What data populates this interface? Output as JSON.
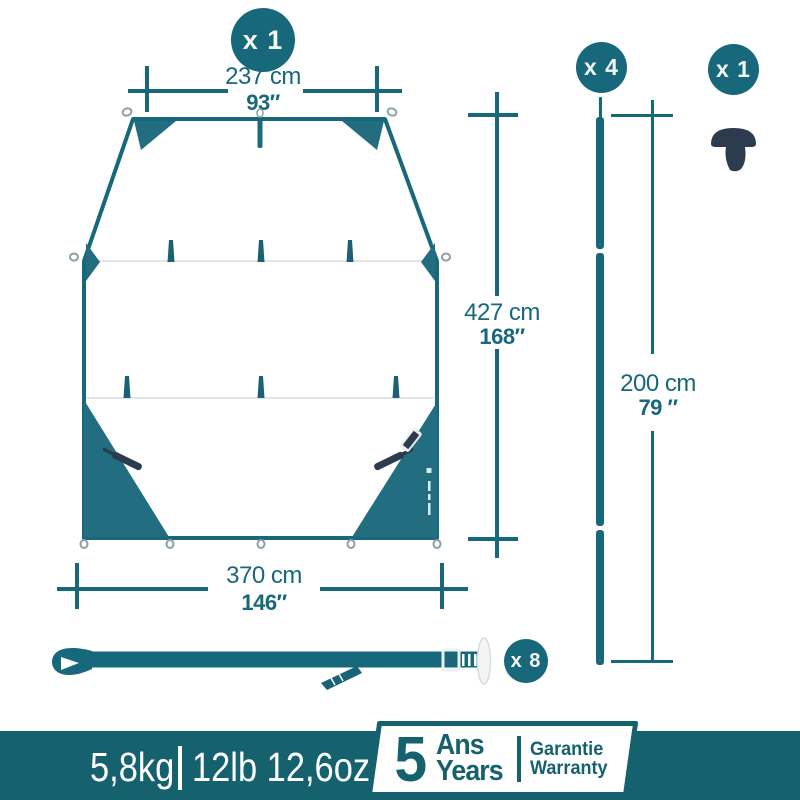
{
  "product": {
    "tarp_qty": "x 1",
    "pole_qty": "x 4",
    "peg_qty": "x 1",
    "strap_qty": "x 8"
  },
  "dimensions": {
    "top_width_cm": "237 cm",
    "top_width_in": "93″",
    "height_cm": "427 cm",
    "height_in": "168″",
    "bottom_width_cm": "370 cm",
    "bottom_width_in": "146″",
    "pole_length_cm": "200 cm",
    "pole_length_in": "79 ″"
  },
  "footer": {
    "weight_metric": "5,8kg",
    "weight_imperial": "12lb 12,6oz",
    "warranty_years": "5",
    "warranty_word_fr": "Ans",
    "warranty_word_en": "Years",
    "warranty_label_fr": "Garantie",
    "warranty_label_en": "Warranty"
  },
  "colors": {
    "teal": "#17687a",
    "tarp_fill_teal": "#236d80",
    "footer_bar_teal": "#15616e",
    "hardware_navy": "#2d3b4f"
  }
}
